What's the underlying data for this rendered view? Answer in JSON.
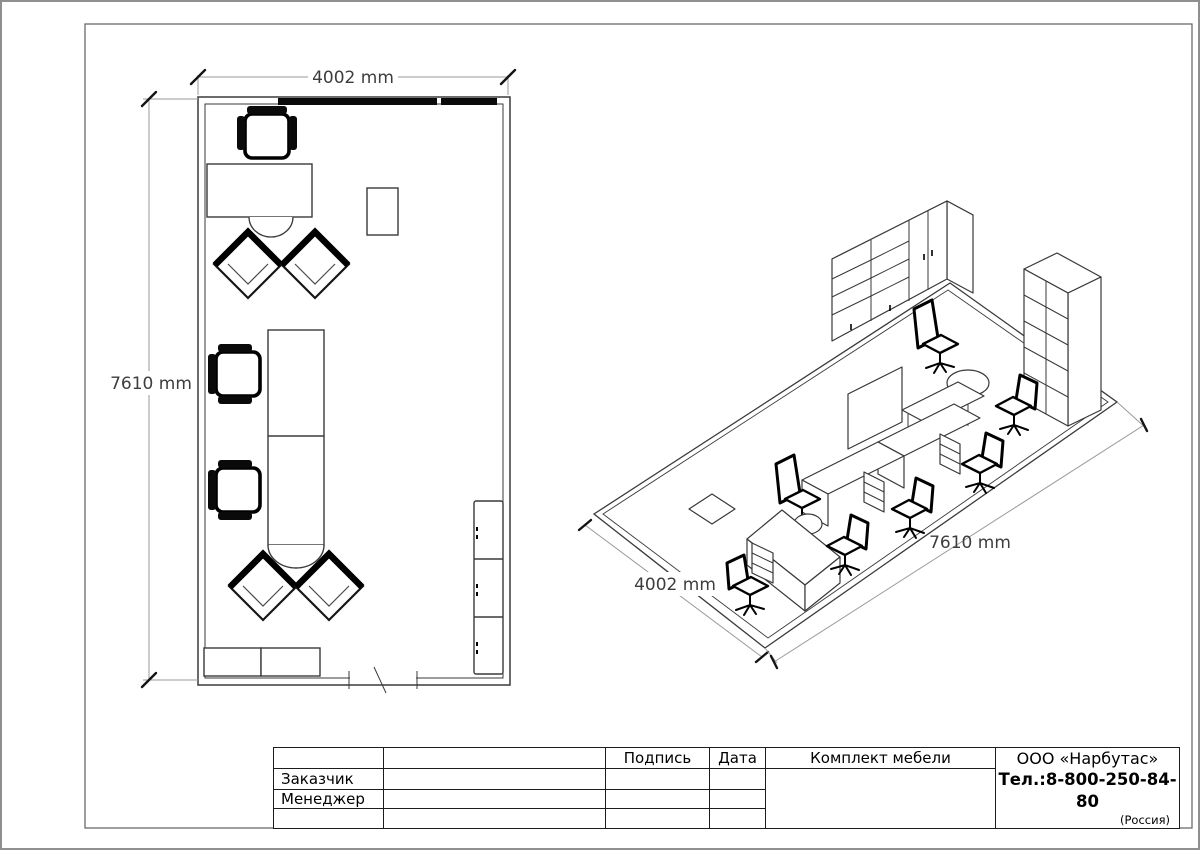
{
  "plan": {
    "width_label": "4002 mm",
    "height_label": "7610 mm"
  },
  "iso": {
    "width_label": "4002 mm",
    "length_label": "7610 mm"
  },
  "title_block": {
    "col_signature": "Подпись",
    "col_date": "Дата",
    "col_set": "Комплект мебели",
    "row_customer": "Заказчик",
    "row_manager": "Менеджер",
    "company_name": "ООО «Нарбутас»",
    "company_phone": "Тел.:8-800-250-84-80",
    "company_country": "(Россия)"
  }
}
